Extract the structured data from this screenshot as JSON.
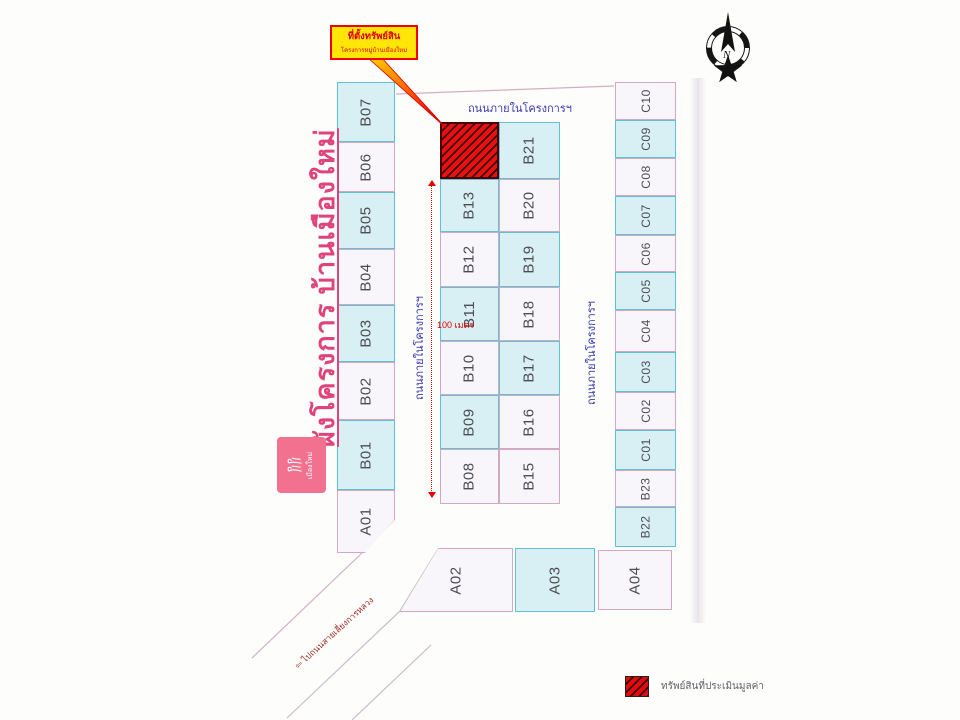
{
  "callout": {
    "title": "ที่ตั้งทรัพย์สิน",
    "subtitle": "โครงการหมู่บ้านเมืองใหม่"
  },
  "compass": {
    "label": "N"
  },
  "title": {
    "text": "ผังโครงการ บ้านเมืองใหม่"
  },
  "logo": {
    "text": "เมืองใหม่"
  },
  "roads": {
    "top_label": "ถนนภายในโครงการฯ",
    "left_label": "ถนนภายในโครงการฯ",
    "right_label": "ถนนภายในโครงการฯ",
    "exit_label": "⇦ ไปถนนสายเลี่ยงการหลวง"
  },
  "dimension": {
    "label": "100 เมตร"
  },
  "legend": {
    "label": "ทรัพย์สินที่ประเมินมูลค่า"
  },
  "colors": {
    "plot_cyan_fill": "#d8f0f4",
    "plot_cyan_border": "#5fc2d4",
    "plot_white_fill": "#f8f6fa",
    "plot_pink_border": "#d2a9c1",
    "subject_red": "#e81010",
    "accent_pink": "#e0437c",
    "road_label_blue": "#3a3ab0",
    "callout_yellow": "#ffe608",
    "callout_red": "#f00000"
  },
  "plots": [
    {
      "id": "B07",
      "label": "B07",
      "x": 337,
      "y": 82,
      "w": 58,
      "h": 60,
      "fill": "cyan"
    },
    {
      "id": "B06",
      "label": "B06",
      "x": 337,
      "y": 142,
      "w": 58,
      "h": 50,
      "fill": "white"
    },
    {
      "id": "B05",
      "label": "B05",
      "x": 337,
      "y": 192,
      "w": 58,
      "h": 57,
      "fill": "cyan"
    },
    {
      "id": "B04",
      "label": "B04",
      "x": 337,
      "y": 249,
      "w": 58,
      "h": 56,
      "fill": "white"
    },
    {
      "id": "B03",
      "label": "B03",
      "x": 337,
      "y": 305,
      "w": 58,
      "h": 57,
      "fill": "cyan"
    },
    {
      "id": "B02",
      "label": "B02",
      "x": 337,
      "y": 362,
      "w": 58,
      "h": 58,
      "fill": "white"
    },
    {
      "id": "B01",
      "label": "B01",
      "x": 337,
      "y": 420,
      "w": 58,
      "h": 70,
      "fill": "cyan"
    },
    {
      "id": "A01",
      "label": "A01",
      "x": 337,
      "y": 490,
      "w": 58,
      "h": 63,
      "fill": "white",
      "clip": "polygon(0 0,100% 0,100% 46%,48% 100%,0 100%)"
    },
    {
      "id": "subject",
      "label": "",
      "x": 440,
      "y": 122,
      "w": 59,
      "h": 57,
      "fill": "red"
    },
    {
      "id": "B13",
      "label": "B13",
      "x": 440,
      "y": 179,
      "w": 59,
      "h": 53,
      "fill": "cyan"
    },
    {
      "id": "B12",
      "label": "B12",
      "x": 440,
      "y": 232,
      "w": 59,
      "h": 55,
      "fill": "white"
    },
    {
      "id": "B11",
      "label": "B11",
      "x": 440,
      "y": 287,
      "w": 59,
      "h": 54,
      "fill": "cyan"
    },
    {
      "id": "B10",
      "label": "B10",
      "x": 440,
      "y": 341,
      "w": 59,
      "h": 54,
      "fill": "white"
    },
    {
      "id": "B09",
      "label": "B09",
      "x": 440,
      "y": 395,
      "w": 59,
      "h": 54,
      "fill": "cyan"
    },
    {
      "id": "B08",
      "label": "B08",
      "x": 440,
      "y": 449,
      "w": 59,
      "h": 55,
      "fill": "white"
    },
    {
      "id": "B21",
      "label": "B21",
      "x": 499,
      "y": 122,
      "w": 61,
      "h": 57,
      "fill": "cyan"
    },
    {
      "id": "B20",
      "label": "B20",
      "x": 499,
      "y": 179,
      "w": 61,
      "h": 53,
      "fill": "white"
    },
    {
      "id": "B19",
      "label": "B19",
      "x": 499,
      "y": 232,
      "w": 61,
      "h": 55,
      "fill": "cyan"
    },
    {
      "id": "B18",
      "label": "B18",
      "x": 499,
      "y": 287,
      "w": 61,
      "h": 54,
      "fill": "white"
    },
    {
      "id": "B17",
      "label": "B17",
      "x": 499,
      "y": 341,
      "w": 61,
      "h": 54,
      "fill": "cyan"
    },
    {
      "id": "B16",
      "label": "B16",
      "x": 499,
      "y": 395,
      "w": 61,
      "h": 54,
      "fill": "white"
    },
    {
      "id": "B15",
      "label": "B15",
      "x": 499,
      "y": 449,
      "w": 61,
      "h": 55,
      "fill": "white"
    },
    {
      "id": "C10",
      "label": "C10",
      "x": 615,
      "y": 82,
      "w": 61,
      "h": 38,
      "fill": "white",
      "small": true
    },
    {
      "id": "C09",
      "label": "C09",
      "x": 615,
      "y": 120,
      "w": 61,
      "h": 38,
      "fill": "cyan",
      "small": true
    },
    {
      "id": "C08",
      "label": "C08",
      "x": 615,
      "y": 158,
      "w": 61,
      "h": 38,
      "fill": "white",
      "small": true
    },
    {
      "id": "C07",
      "label": "C07",
      "x": 615,
      "y": 196,
      "w": 61,
      "h": 39,
      "fill": "cyan",
      "small": true
    },
    {
      "id": "C06",
      "label": "C06",
      "x": 615,
      "y": 235,
      "w": 61,
      "h": 37,
      "fill": "white",
      "small": true
    },
    {
      "id": "C05",
      "label": "C05",
      "x": 615,
      "y": 272,
      "w": 61,
      "h": 38,
      "fill": "cyan",
      "small": true
    },
    {
      "id": "C04",
      "label": "C04",
      "x": 615,
      "y": 310,
      "w": 61,
      "h": 42,
      "fill": "white",
      "small": true
    },
    {
      "id": "C03",
      "label": "C03",
      "x": 615,
      "y": 352,
      "w": 61,
      "h": 40,
      "fill": "cyan",
      "small": true
    },
    {
      "id": "C02",
      "label": "C02",
      "x": 615,
      "y": 392,
      "w": 61,
      "h": 38,
      "fill": "white",
      "small": true
    },
    {
      "id": "C01",
      "label": "C01",
      "x": 615,
      "y": 430,
      "w": 61,
      "h": 40,
      "fill": "cyan",
      "small": true
    },
    {
      "id": "B23",
      "label": "B23",
      "x": 615,
      "y": 470,
      "w": 61,
      "h": 37,
      "fill": "white",
      "small": true
    },
    {
      "id": "B22",
      "label": "B22",
      "x": 615,
      "y": 507,
      "w": 61,
      "h": 40,
      "fill": "cyan",
      "small": true
    },
    {
      "id": "A02",
      "label": "A02",
      "x": 400,
      "y": 548,
      "w": 113,
      "h": 64,
      "fill": "white",
      "clip": "polygon(34% 0,100% 0,100% 100%,0 100%)"
    },
    {
      "id": "A03",
      "label": "A03",
      "x": 515,
      "y": 548,
      "w": 80,
      "h": 64,
      "fill": "cyan"
    },
    {
      "id": "A04",
      "label": "A04",
      "x": 598,
      "y": 550,
      "w": 74,
      "h": 60,
      "fill": "white"
    }
  ]
}
